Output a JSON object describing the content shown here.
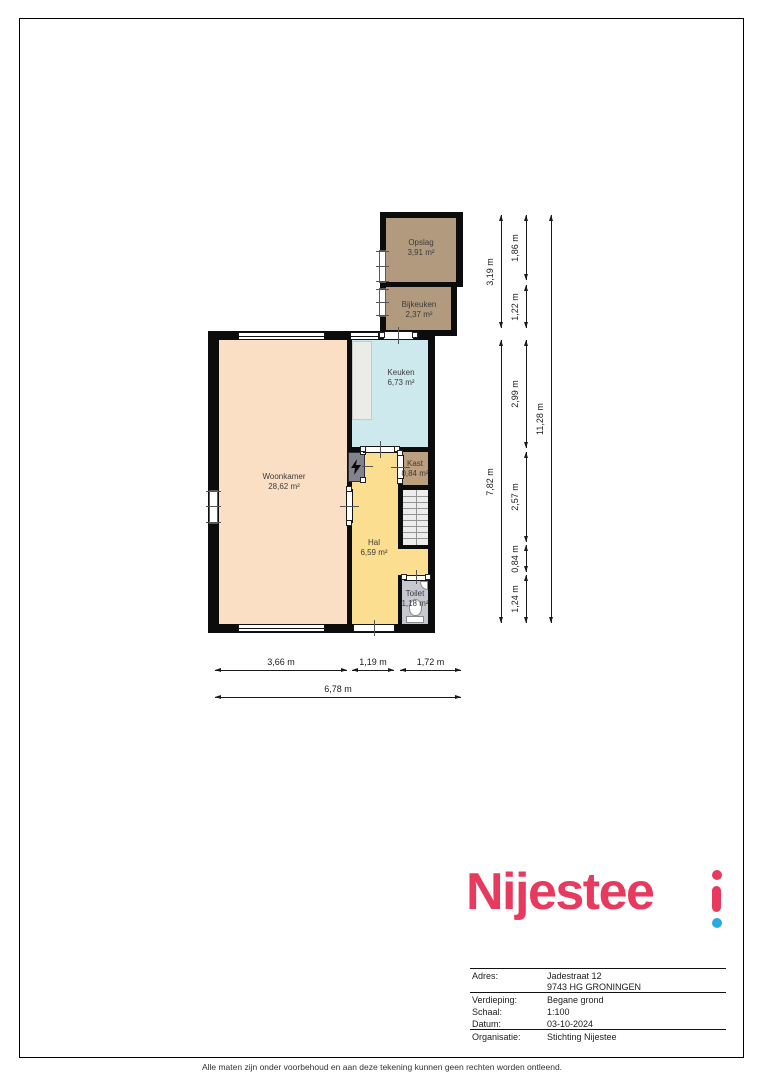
{
  "document": {
    "footer": "Alle maten zijn onder voorbehoud en aan deze tekening kunnen geen rechten worden ontleend."
  },
  "logo": {
    "wordmark": "Nijestee",
    "pink": "#e73a5e",
    "blue": "#2aa9e0"
  },
  "info": {
    "labels": {
      "address": "Adres:",
      "floor": "Verdieping:",
      "scale": "Schaal:",
      "date": "Datum:",
      "organisation": "Organisatie:"
    },
    "values": {
      "address1": "Jadestraat 12",
      "address2": "9743 HG GRONINGEN",
      "floor": "Begane grond",
      "scale": "1:100",
      "date": "03-10-2024",
      "organisation": "Stichting Nijestee"
    }
  },
  "floorplan": {
    "wall_color": "#0c0c0c",
    "rooms": {
      "opslag": {
        "name": "Opslag",
        "area": "3,91 m²",
        "color": "#b29a7e"
      },
      "bijkeuken": {
        "name": "Bijkeuken",
        "area": "2,37 m²",
        "color": "#b29a7e"
      },
      "keuken": {
        "name": "Keuken",
        "area": "6,73 m²",
        "color": "#cee9ee"
      },
      "woonkamer": {
        "name": "Woonkamer",
        "area": "28,62 m²",
        "color": "#fbdfc4"
      },
      "kast": {
        "name": "Kast",
        "area": "0,84 m²",
        "color": "#bc9f7e"
      },
      "hal": {
        "name": "Hal",
        "area": "6,59 m²",
        "color": "#fbde8f"
      },
      "toilet": {
        "name": "Toilet",
        "area": "1,18 m²",
        "color": "#c7c7d1"
      }
    },
    "dims": {
      "right_inner": [
        "3,19 m",
        "7,82 m"
      ],
      "right_mid": [
        "1,86 m",
        "1,22 m",
        "2,99 m",
        "2,57 m",
        "0,84 m",
        "1,24 m"
      ],
      "right_outer": [
        "11,28 m"
      ],
      "bottom_inner": [
        "3,66 m",
        "1,19 m",
        "1,72 m"
      ],
      "bottom_outer": [
        "6,78 m"
      ]
    }
  }
}
